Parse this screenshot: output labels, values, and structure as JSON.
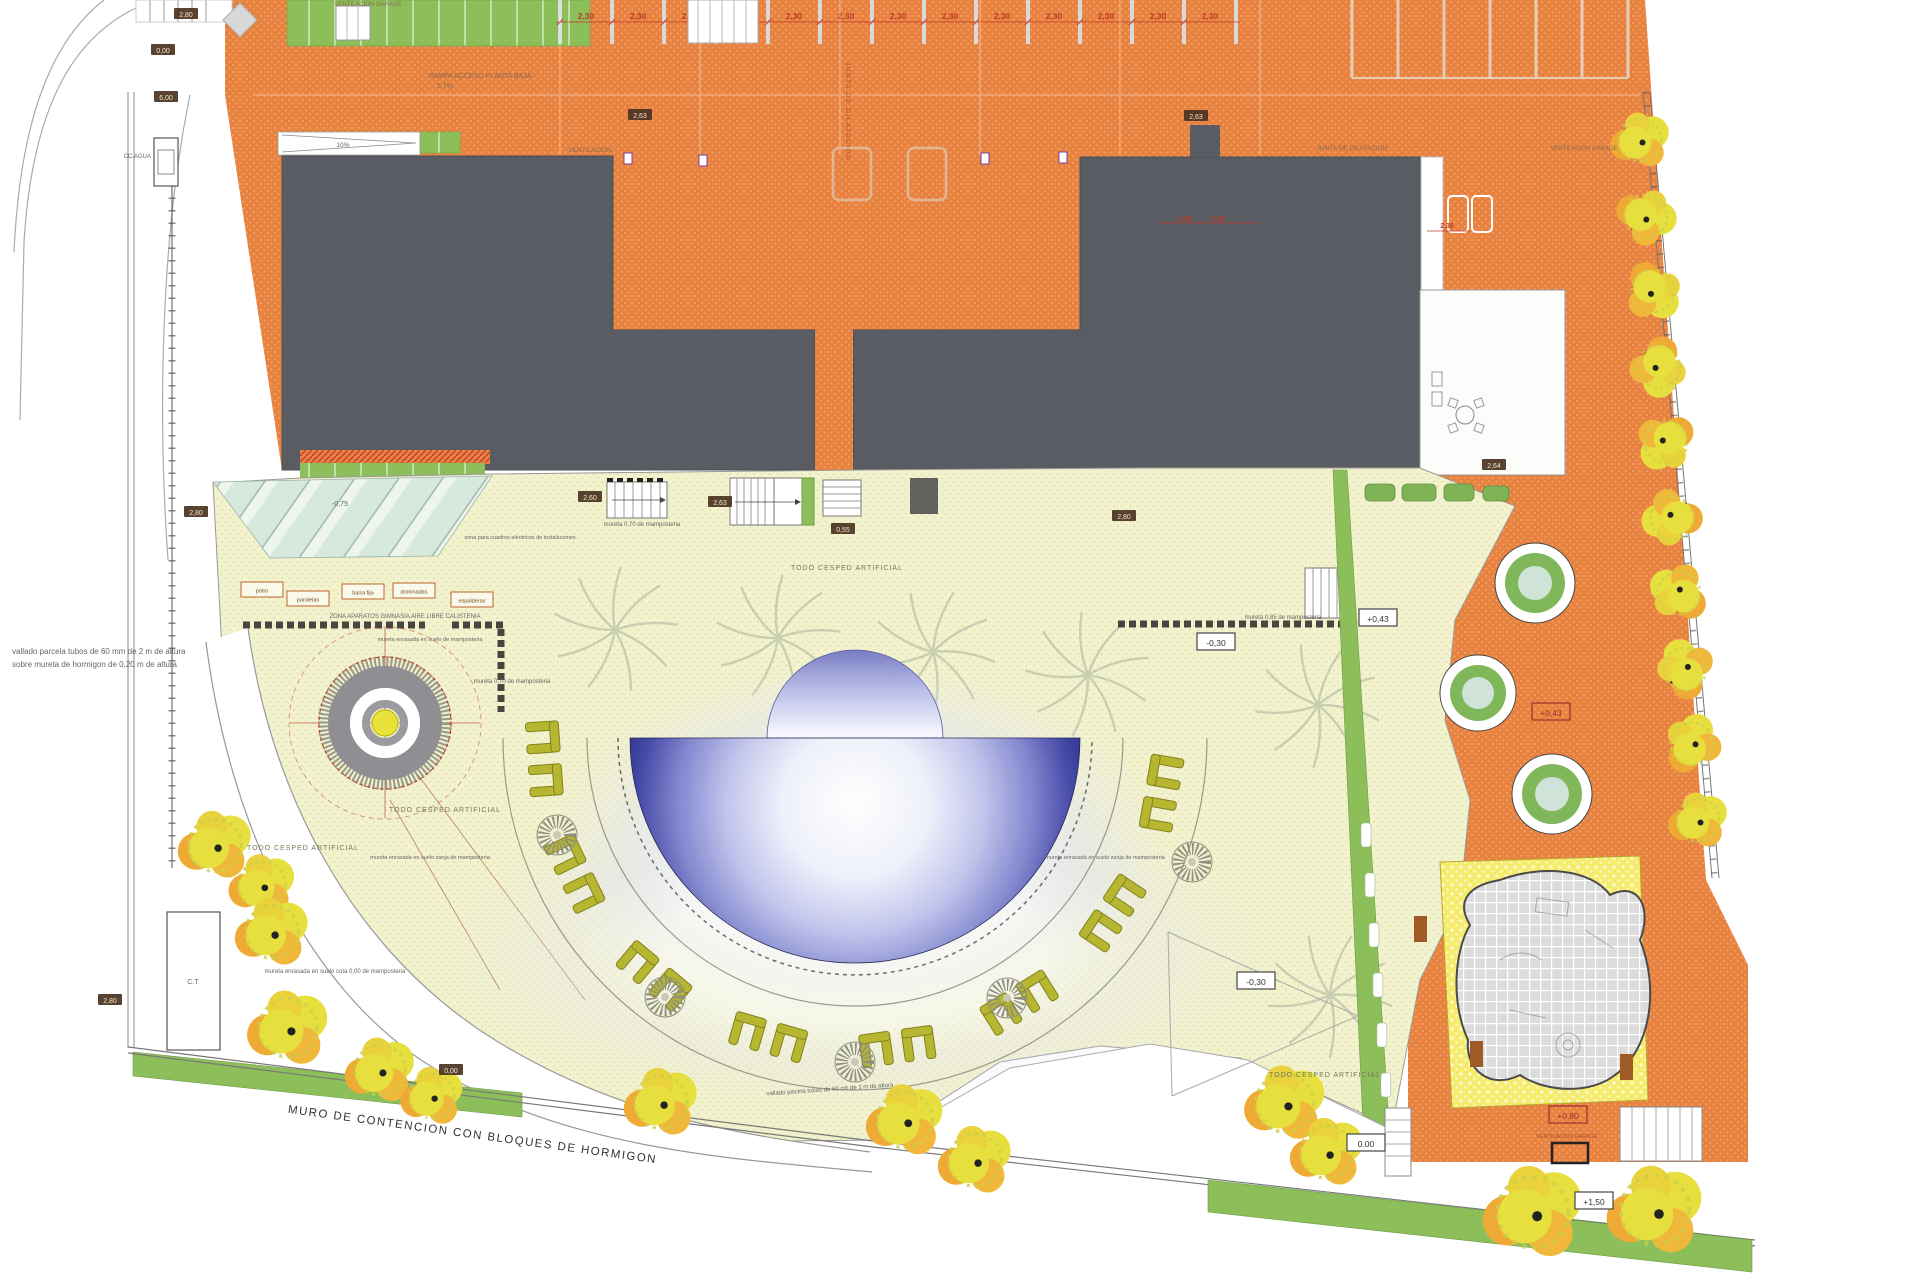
{
  "title": "Plano de urbanizacion y jardineria",
  "labels": {
    "vent_garage": "VENTILACION GARAGE",
    "vent": "VENTILACION",
    "rampa1": "RAMPA ACCESO PLANTA BAJA",
    "rampa2": "5.7%",
    "p10": "10%",
    "ccagua": "CC.AGUA",
    "junta": "JUNTA DE DILATACION",
    "vallado1": "vallado parcela tubos de 60 mm de 2 m de altura",
    "vallado2": "sobre mureta de hormigon de 0,20 m de altura",
    "zona_cuadros": "zona para cuadros electricos de instalaciones",
    "mureta070": "mureta 0,70 de mamposteria",
    "zona_aparatos": "ZONA APARATOS GIMNASIA AIRE LIBRE CALISTENIA",
    "mureta_enr": "mureta enrasada en suelo de mamposteria",
    "todo_cesped": "TODO CESPED ARTIFICIAL",
    "mureta085": "mureta 0,85 de mamposteria",
    "mureta_zanja": "mureta enrasada en suelo zanja de mamposteria",
    "mureta_cota": "mureta enrasada en suelo cota 0,00 de mamposteria",
    "vallado_piscina": "vallado piscina tubos de 60 cm de 1 m de altura",
    "muro": "MURO DE CONTENCION  CON BLOQUES DE HORMIGON",
    "ct": "C.T"
  },
  "equipment": [
    "potro",
    "paralelas",
    "barra fija",
    "dominadas",
    "espalderas"
  ],
  "levels": {
    "m075": "-0,75",
    "m030": "-0,30",
    "p043": "+0,43",
    "p080": "+0,80",
    "p150": "+1,50",
    "zero": "0,00",
    "zero_dot": "0.00"
  },
  "dims": {
    "d230": "2,30",
    "d236": "2,36",
    "d260": "2,60",
    "d263": "2,63",
    "d264": "2,64",
    "d280": "2,80",
    "d055": "0,55",
    "d000": "0,00",
    "d600": "6,00"
  },
  "colors": {
    "orange_paving": "#e8823f",
    "building": "#595d63",
    "cesped": "#f2f2cf",
    "green": "#8cbf5a",
    "pool_deep": "#262a88",
    "bench": "#b6b630",
    "tree_yellow": "#e6df3d",
    "tree_orange": "#eeaa35",
    "accent_red": "#c0392b"
  }
}
